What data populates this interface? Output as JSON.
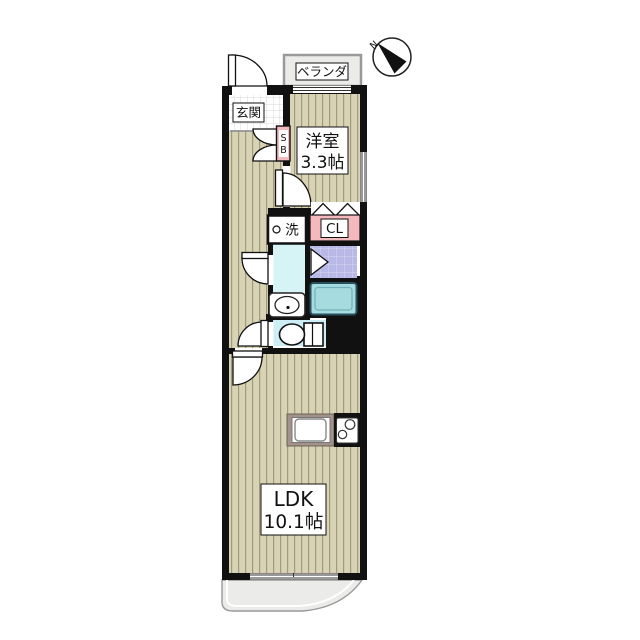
{
  "plan": {
    "type": "floor-plan",
    "compass": {
      "north_label": "N"
    },
    "balcony_top": {
      "label": "ベランダ"
    },
    "balcony_bottom": {
      "label": ""
    },
    "entrance": {
      "label": "玄関"
    },
    "shoe_box": {
      "label_s": "S",
      "label_b": "B"
    },
    "western_room": {
      "name": "洋室",
      "size": "3.3帖"
    },
    "washer_space": {
      "label": "洗"
    },
    "closet": {
      "label": "CL"
    },
    "ldk": {
      "name": "LDK",
      "size": "10.1帖"
    }
  },
  "colors": {
    "wall": "#111111",
    "flooring": "#d9d3b5",
    "flooring_stripe": "#a19b7e",
    "entrance_tile": "#ffffff",
    "entrance_tile_line": "#d8d8d8",
    "balcony_gray": "#ebebe9",
    "balcony_border": "#999999",
    "pink": "#f4b9bd",
    "washroom_cyan": "#d6f3f6",
    "toilet_cyan": "#cdeef5",
    "bath_purple": "#b9b9e7",
    "bath_purple_grid": "#d8d8f4",
    "tub_fill": "#a6dbe0",
    "tub_border": "#27505c",
    "counter_taupe": "#a39289"
  }
}
